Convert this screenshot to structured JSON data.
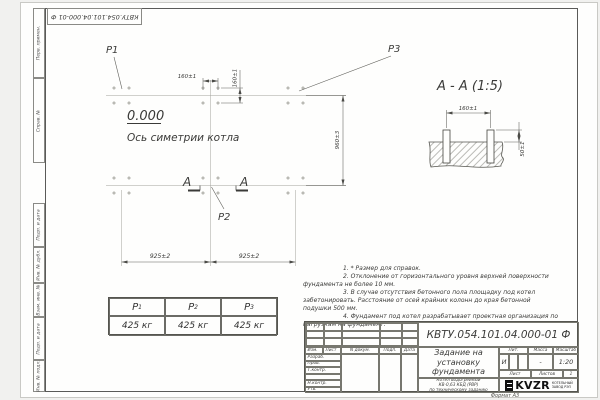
{
  "frame": {
    "doc_number_top": "КВТУ.054.101.04.000-01 Ф"
  },
  "margin": {
    "labels": [
      "Перв. примен.",
      "Справ. №",
      "Подп. и дата",
      "Инв. № дубл.",
      "Взам. инв. №",
      "Подп. и дата",
      "Инв. № подл."
    ]
  },
  "plan": {
    "p1": "Р1",
    "p2": "Р2",
    "p3": "Р3",
    "elevation": "0.000",
    "axis_label": "Ось симетрии котла",
    "section_letter": "А",
    "dims": {
      "w160": "160±1",
      "h160": "160±1",
      "h960": "960±3",
      "w925a": "925±2",
      "w925b": "925±2"
    }
  },
  "section": {
    "title": "А - А (1:5)",
    "dim_width": "160±1",
    "dim_height": "50±1"
  },
  "notes": [
    "1. * Размер для справок.",
    "2. Отклонение от горизонтального уровня верхней поверхности фундамента не более 10 мм.",
    "3. В случае отсутствия бетонного пола площадку под котел забетонировать. Расстояние от осей крайних колонн до края бетонной подушки 500 мм.",
    "4. Фундамент под котел разрабатывает проектная организация по нагрузкам на фундамент."
  ],
  "load_table": {
    "headers": [
      {
        "name": "Р",
        "sub": "1"
      },
      {
        "name": "Р",
        "sub": "2"
      },
      {
        "name": "Р",
        "sub": "3"
      }
    ],
    "values": [
      "425 кг",
      "425 кг",
      "425 кг"
    ]
  },
  "tb": {
    "doc_number": "КВТУ.054.101.04.000-01 Ф",
    "rev_headers": [
      "Изм.",
      "Лист",
      "N докум.",
      "Подп.",
      "Дата"
    ],
    "rows": [
      "Разраб.",
      "Пров.",
      "Т.контр.",
      "",
      "Н.контр.",
      "Утв."
    ],
    "title": "Задание на установку фундамента",
    "product": [
      "Котел водогрейный",
      "КВ-0,63 КБД (РВР)",
      "по техническому заданию"
    ],
    "lit_h": "Лит.",
    "mass_h": "Масса",
    "scale_h": "Масштаб",
    "lit_v": "И",
    "mass_v": "-",
    "scale_v": "1:20",
    "sheet_h": "Лист",
    "sheets_h": "Листов",
    "sheets_v": "1",
    "brand": "KVZR",
    "brand_sub": [
      "КОТЕЛЬНЫЙ",
      "ЗАВОД РЭП"
    ],
    "format": "Формат А3"
  }
}
